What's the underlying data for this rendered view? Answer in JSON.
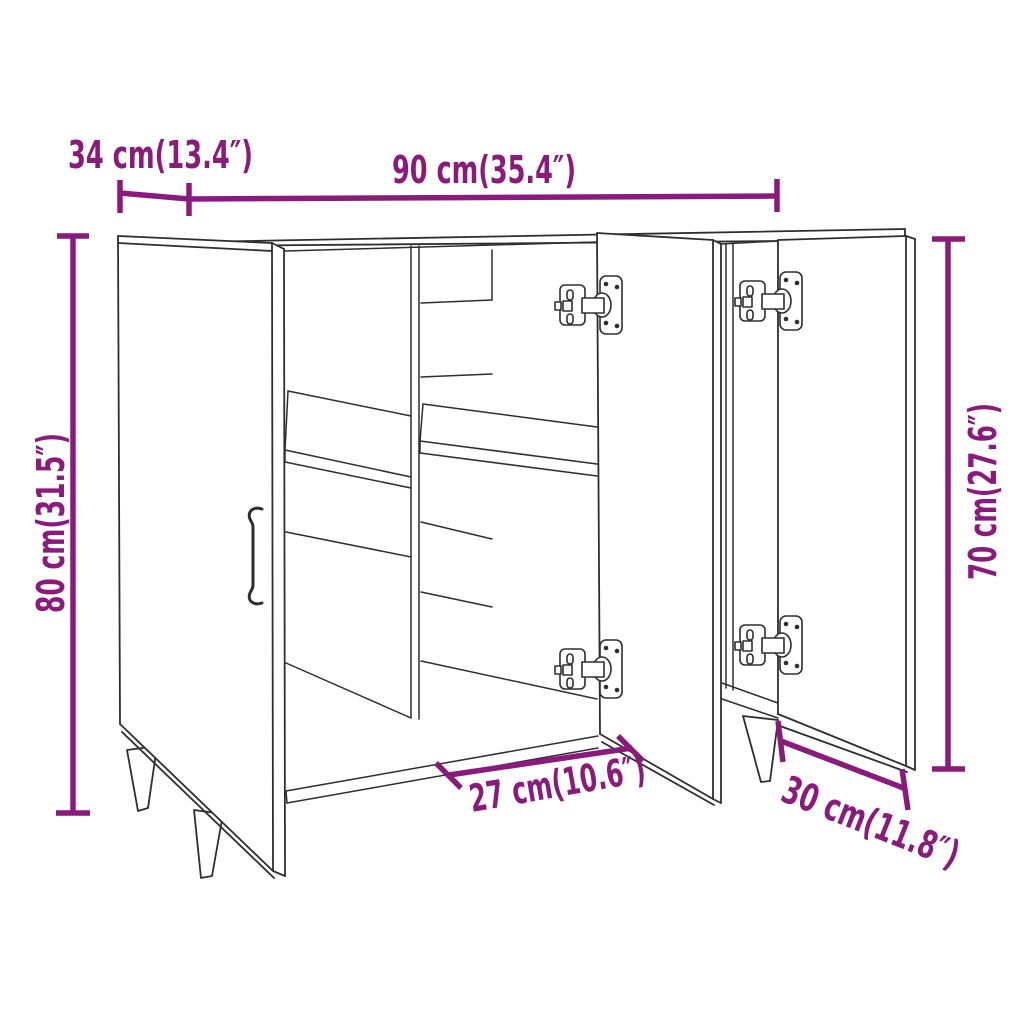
{
  "diagram": {
    "kind": "furniture dimension line drawing",
    "product": "sideboard with three open doors, two shelves and tapered legs",
    "accent_color": "#8a1a7c",
    "line_color": "#2e2e2e",
    "background_color": "#ffffff"
  },
  "dimensions": {
    "depth": {
      "label": "34 cm(13.4″)",
      "cm": 34,
      "in": 13.4,
      "position": "top-left"
    },
    "width": {
      "label": "90 cm(35.4″)",
      "cm": 90,
      "in": 35.4,
      "position": "top"
    },
    "height": {
      "label": "80 cm(31.5″)",
      "cm": 80,
      "in": 31.5,
      "position": "left"
    },
    "door_height": {
      "label": "70 cm(27.6″)",
      "cm": 70,
      "in": 27.6,
      "position": "right"
    },
    "middle_door_width": {
      "label": "27 cm(10.6″)",
      "cm": 27,
      "in": 10.6,
      "position": "bottom-center"
    },
    "right_door_width": {
      "label": "30 cm(11.8″)",
      "cm": 30,
      "in": 11.8,
      "position": "bottom-right"
    }
  }
}
